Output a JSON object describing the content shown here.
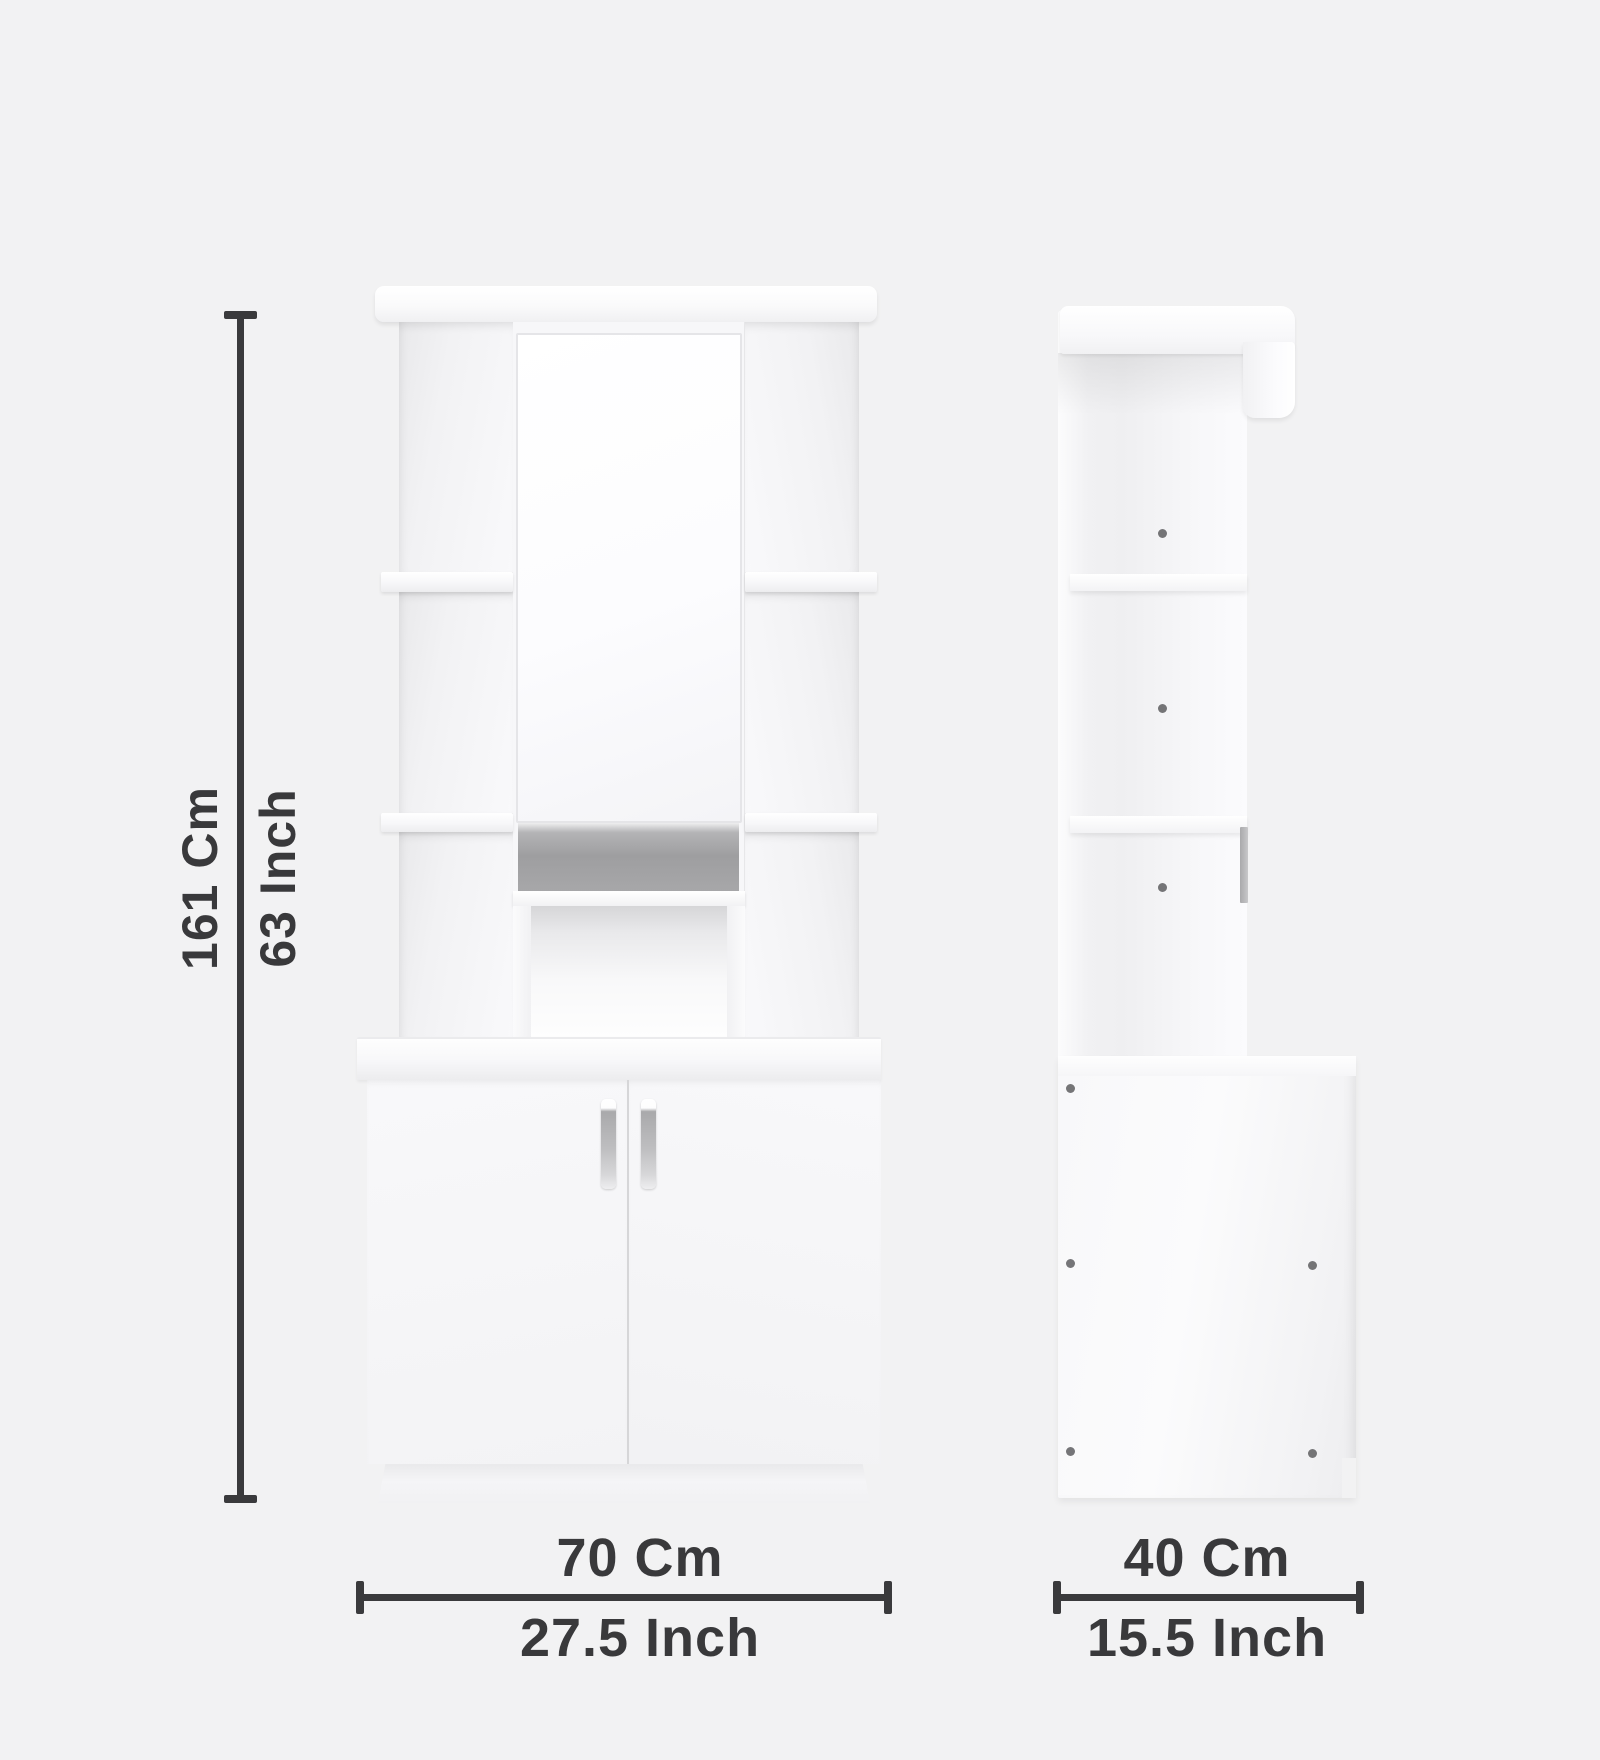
{
  "background": "#f2f2f3",
  "dimensions": {
    "height": {
      "cm": "161 Cm",
      "inch": "63 Inch"
    },
    "width": {
      "cm": "70 Cm",
      "inch": "27.5 Inch"
    },
    "depth": {
      "cm": "40 Cm",
      "inch": "15.5 Inch"
    }
  },
  "colors": {
    "dimension_line": "#3a3a3c",
    "dimension_text": "#39393b",
    "furniture_white": "#f8f8fa",
    "mirror_strip_gray": "#9e9ea0",
    "handle_metal": "#bebec0",
    "peg_dot": "#58585a"
  }
}
